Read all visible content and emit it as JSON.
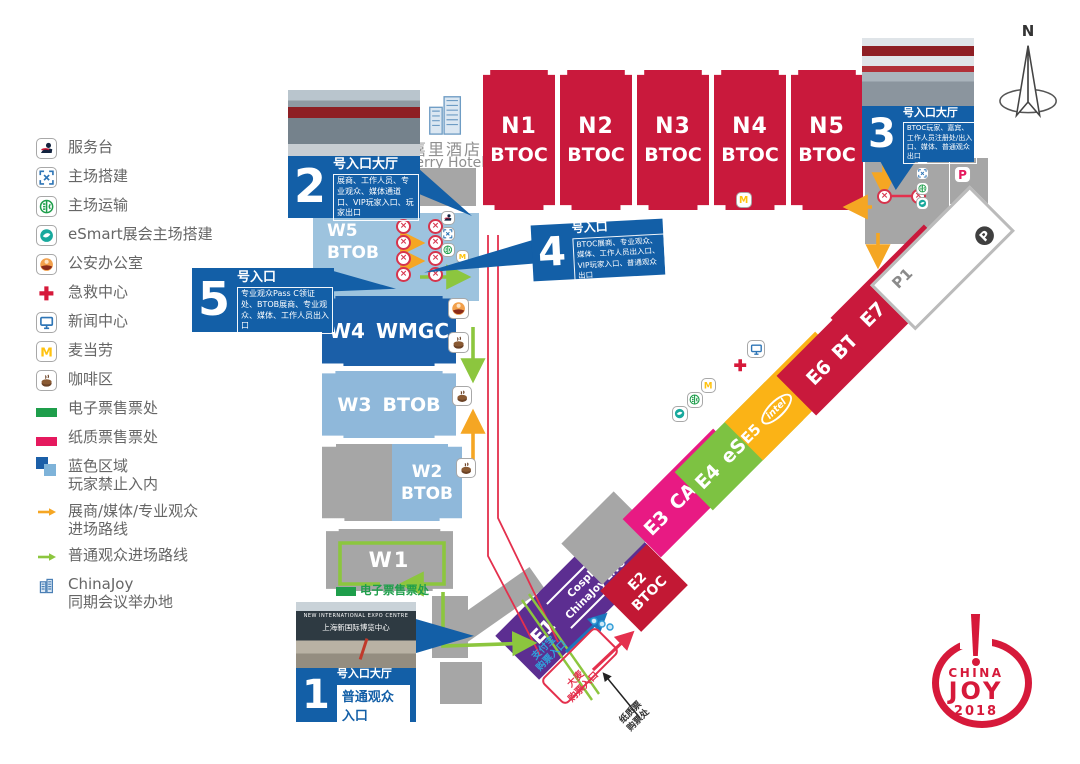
{
  "title": "ChinaJoy 2018 场馆地图",
  "compass": {
    "north": "N"
  },
  "kerry_hotel": {
    "name_cn": "嘉里酒店",
    "name_en": "Kerry Hotel"
  },
  "legend": {
    "items": [
      {
        "icon": "service-desk",
        "label": "服务台"
      },
      {
        "icon": "venue-setup",
        "label": "主场搭建"
      },
      {
        "icon": "venue-transport",
        "label": "主场运输"
      },
      {
        "icon": "esmart-setup",
        "label": "eSmart展会主场搭建"
      },
      {
        "icon": "police-office",
        "label": "公安办公室"
      },
      {
        "icon": "first-aid",
        "label": "急救中心"
      },
      {
        "icon": "news-center",
        "label": "新闻中心"
      },
      {
        "icon": "mcdonalds",
        "label": "麦当劳"
      },
      {
        "icon": "coffee",
        "label": "咖啡区"
      },
      {
        "icon": "eticket-bar",
        "label": "电子票售票处"
      },
      {
        "icon": "paper-ticket-bar",
        "label": "纸质票售票处"
      },
      {
        "icon": "blue-zone",
        "label": "蓝色区域",
        "label2": "玩家禁止入内"
      },
      {
        "icon": "route-pro",
        "label": "展商/媒体/专业观众",
        "label2": "进场路线"
      },
      {
        "icon": "route-public",
        "label": "普通观众进场路线"
      },
      {
        "icon": "chinajoy-building",
        "label": "ChinaJoy",
        "label2": "同期会议举办地"
      }
    ]
  },
  "n_halls": [
    {
      "id": "N1",
      "type": "BTOC"
    },
    {
      "id": "N2",
      "type": "BTOC"
    },
    {
      "id": "N3",
      "type": "BTOC"
    },
    {
      "id": "N4",
      "type": "BTOC"
    },
    {
      "id": "N5",
      "type": "BTOC"
    }
  ],
  "w_halls": {
    "w5": {
      "id": "W5",
      "type": "BTOB"
    },
    "w4": {
      "id": "W4",
      "type": "WMGC"
    },
    "w3": {
      "id": "W3",
      "type": "BTOB"
    },
    "w2": {
      "id": "W2",
      "type": "BTOB"
    },
    "w1": {
      "id": "W1"
    }
  },
  "e_halls": {
    "e1": {
      "id": "E1",
      "sub1": "Cosplay",
      "sub2": "ChinaJoy Live"
    },
    "e2": {
      "id": "E2",
      "type": "BTOC"
    },
    "e3": {
      "id": "E3",
      "type": "CAWAE"
    },
    "e4": {
      "id": "E4",
      "type": "eSmart"
    },
    "e5": {
      "id": "E5",
      "brand": "intel",
      "type": "英特尔主题馆"
    },
    "e6": {
      "id": "E6",
      "type": "BTOC"
    },
    "e7": {
      "id": "E7",
      "type": "BTOC"
    }
  },
  "parking": {
    "p1": "P1",
    "p_badge": "P"
  },
  "entrances": [
    {
      "num": "1",
      "title": "号入口大厅",
      "gate_box": "普通观众入口"
    },
    {
      "num": "2",
      "title": "号入口大厅",
      "desc": "展商、工作人员、专业观众、媒体通道口、VIP玩家入口、玩家出口"
    },
    {
      "num": "3",
      "title": "号入口大厅",
      "desc": "BTOC玩家、嘉宾、工作人员注册处/出入口、媒体、普通观众出口"
    },
    {
      "num": "4",
      "title": "号入口",
      "desc": "BTOC展商、专业观众、媒体、工作人员出入口、VIP玩家入口、普通观众出口"
    },
    {
      "num": "5",
      "title": "号入口",
      "desc": "专业观众Pass C领证处、BTOB展商、专业观众、媒体、工作人员出入口"
    }
  ],
  "photo1": {
    "caption_en": "NEW INTERNATIONAL EXPO CENTRE",
    "caption_cn": "上海新国际博览中心"
  },
  "map_labels": {
    "eticket_booth": "电子票售票处",
    "alipay": [
      "支付宝",
      "购票入口"
    ],
    "damai": [
      "大麦",
      "购票入口"
    ],
    "paper_ticket": [
      "纸质票",
      "购票处"
    ]
  },
  "logo": {
    "top": "CHINA",
    "mid": "JOY",
    "year": "2018"
  },
  "icons": {
    "service-desk": "concierge service figure",
    "venue-setup": "blue corner brackets",
    "venue-transport": "green circle with E/C",
    "esmart-setup": "teal swirl circle",
    "police-office": "police officer face",
    "first-aid": "red cross",
    "news-center": "blue monitor",
    "mcdonalds": "yellow M",
    "coffee": "coffee cup",
    "chinajoy-building": "conference building",
    "gate": "red circle with x (ticket gate)",
    "p-pink": "pink P parking badge",
    "p-dark": "dark circle white P",
    "north-compass": "north arrow"
  },
  "colors": {
    "hall_red": "#C9193C",
    "hall_blue_dark": "#1B5FA8",
    "hall_blue_light": "#8FB8DA",
    "hall_gray": "#A6A6A6",
    "e1_purple": "#5C2E91",
    "e3_magenta": "#E81A83",
    "e4_green": "#7DC242",
    "e5_yellow": "#FBB316",
    "callout_blue": "#135FA7",
    "route_orange": "#F5A623",
    "route_green": "#8CC63E",
    "ticket_green": "#1E9E4B",
    "ticket_pink": "#E5195E",
    "logo_red": "#D6193A"
  }
}
